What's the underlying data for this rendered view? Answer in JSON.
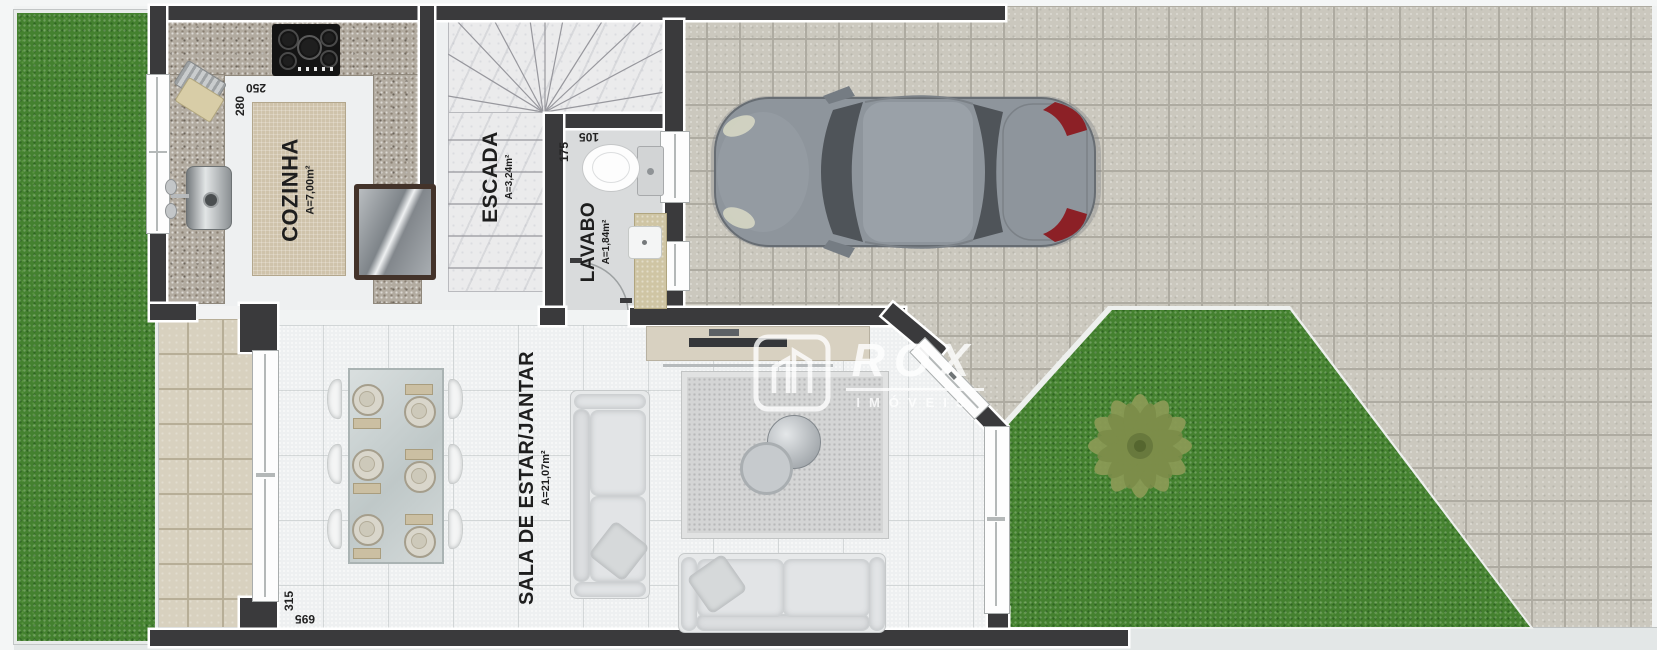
{
  "watermark": {
    "brand": "ROX",
    "subtitle": "IMÓVEIS"
  },
  "rooms": {
    "cozinha": {
      "label": "COZINHA",
      "area": "A=7,00m²"
    },
    "escada": {
      "label": "ESCADA",
      "area": "A=3,24m²"
    },
    "lavabo": {
      "label": "LAVABO",
      "area": "A=1,84m²"
    },
    "sala": {
      "label": "SALA DE ESTAR/JANTAR",
      "area": "A=21,07m²"
    }
  },
  "dimensions": {
    "kitchen_width": "250",
    "kitchen_depth": "280",
    "lavabo_depth": "175",
    "lavabo_width": "105",
    "sala_width": "315",
    "sala_length": "695"
  },
  "colors": {
    "wall": "#3a3a3c",
    "grass": "#44812f",
    "paver": "#cbc8be",
    "patio": "#d8d1bf",
    "floor": "#eef0f1",
    "taillight_red": "#8c2026"
  }
}
